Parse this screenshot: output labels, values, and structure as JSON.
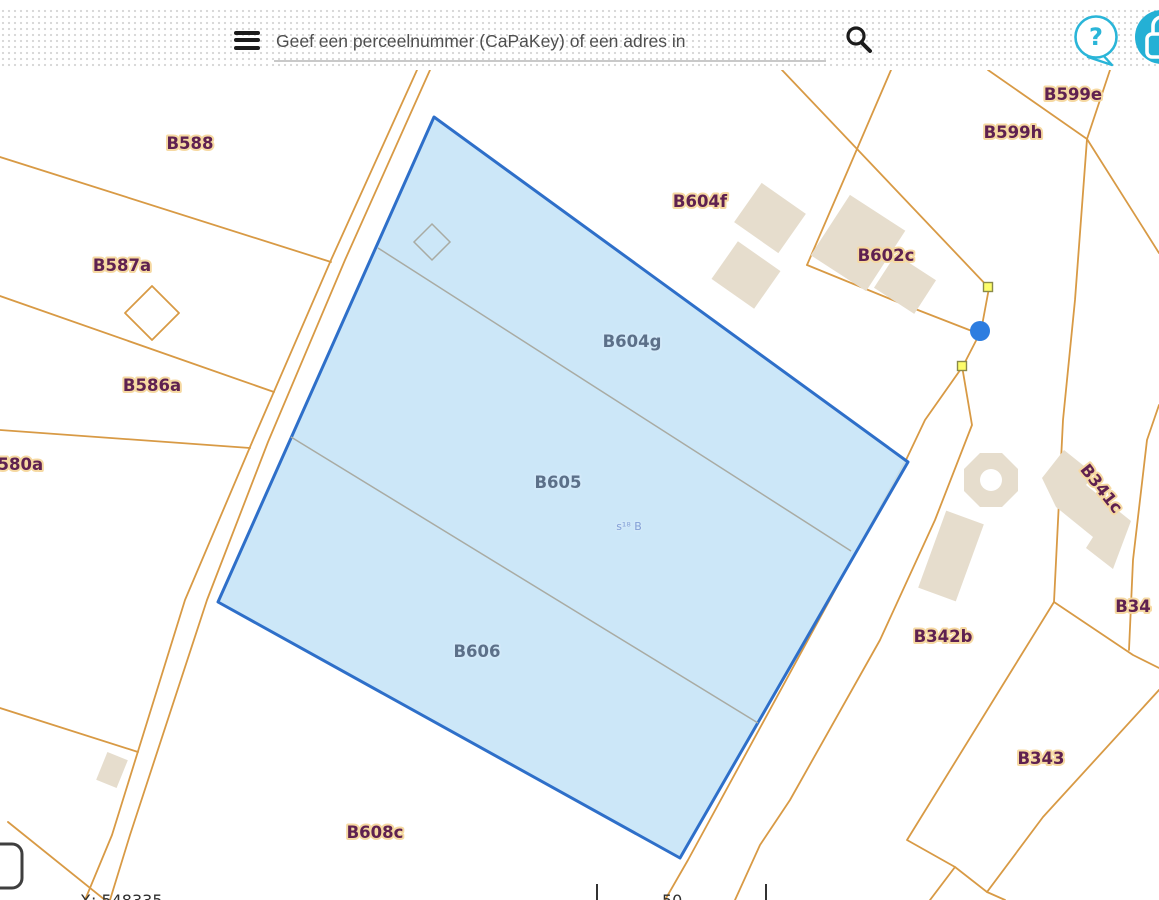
{
  "header": {
    "search_placeholder": "Geef een perceelnummer (CaPaKey) of een adres in",
    "help_glyph": "?",
    "accent_color": "#2ab5d8",
    "icons": {
      "menu": "hamburger",
      "search": "magnifier",
      "help": "question-bubble",
      "login": "padlock"
    }
  },
  "map": {
    "colors": {
      "parcel_line": "#d89a45",
      "selection_stroke": "#2e6fc9",
      "selection_fill": "#c6e4f7",
      "building_fill": "#e6ddcd",
      "vertex_marker": "#fdfd6a",
      "edit_point": "#2d7de0"
    },
    "labels": [
      {
        "text": "B588"
      },
      {
        "text": "B587a"
      },
      {
        "text": "B586a"
      },
      {
        "text": "B580a"
      },
      {
        "text": "B604f"
      },
      {
        "text": "B602c"
      },
      {
        "text": "B599e"
      },
      {
        "text": "B599h"
      },
      {
        "text": "B341c"
      },
      {
        "text": "B342b"
      },
      {
        "text": "B343"
      },
      {
        "text": "B34"
      },
      {
        "text": "B608c"
      }
    ],
    "selected": {
      "labels": [
        {
          "text": "B604g"
        },
        {
          "text": "B605"
        },
        {
          "text": "B606"
        }
      ],
      "sub_label": "s¹⁸ B"
    },
    "status": {
      "x_coordinate": "X: 548335"
    },
    "scale": {
      "value": "50"
    }
  }
}
